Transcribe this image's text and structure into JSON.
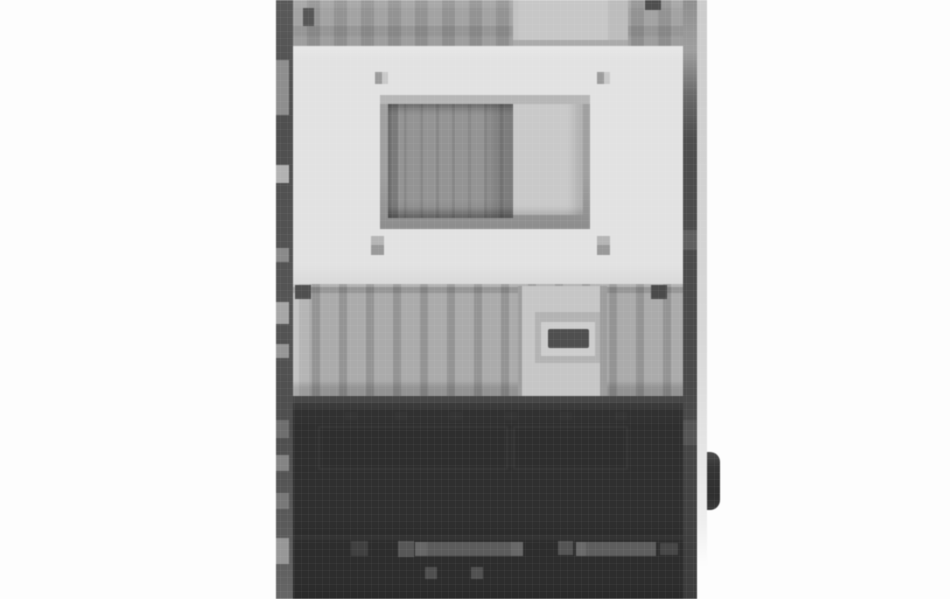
{
  "scene": {
    "type": "photograph",
    "subject": "Heavily pixelated front view of a tall gray industrial machine cabinet standing on a white background; image cropped at top and bottom",
    "background_color": "#fdfdfd"
  },
  "palette": {
    "background": "#fdfdfd",
    "frame_dark": "#4f4f4f",
    "frame_light": "#d8d8d8",
    "ribbed_light": "#a8a8a8",
    "ribbed_dark": "#939393",
    "face_panel": "#e2e2e2",
    "window_frame": "#a0a0a0",
    "window_dark_pane": "#909090",
    "window_light_pane": "#c9c9c9",
    "drawer_strip": "#c6c6c6",
    "handle_slot": "#4f4f4f",
    "lower_housing": "#2f2f2f",
    "bottom_housing": "#2d2d2d",
    "knob": "#333333"
  },
  "device": {
    "left_frame": {
      "color": "#4f4f4f",
      "patches": [
        {
          "l": 0,
          "t": 60,
          "w": 13,
          "h": 55,
          "c": "#8e8e8e",
          "name": "left-frame-highlight"
        },
        {
          "l": 0,
          "t": 165,
          "w": 13,
          "h": 18,
          "c": "#b2b2b2",
          "name": "left-frame-highlight"
        },
        {
          "l": 0,
          "t": 248,
          "w": 13,
          "h": 14,
          "c": "#8a8a8a",
          "name": "left-frame-highlight"
        },
        {
          "l": 0,
          "t": 302,
          "w": 13,
          "h": 22,
          "c": "#a6a6a6",
          "name": "left-frame-highlight"
        },
        {
          "l": 0,
          "t": 344,
          "w": 13,
          "h": 14,
          "c": "#969696",
          "name": "left-frame-highlight"
        },
        {
          "l": 0,
          "t": 420,
          "w": 13,
          "h": 18,
          "c": "#6e6e6e",
          "name": "left-frame-shadow"
        },
        {
          "l": 0,
          "t": 455,
          "w": 13,
          "h": 16,
          "c": "#848484",
          "name": "left-frame-highlight"
        },
        {
          "l": 0,
          "t": 493,
          "w": 13,
          "h": 16,
          "c": "#787878",
          "name": "left-frame-highlight"
        },
        {
          "l": 0,
          "t": 538,
          "w": 13,
          "h": 26,
          "c": "#979797",
          "name": "left-frame-highlight"
        }
      ]
    },
    "right_frame": {
      "dark_color": "#4a4a4a",
      "light_color": "#d8d8d8",
      "patches": [
        {
          "l": 0,
          "t": 230,
          "w": 14,
          "h": 20,
          "c": "#5f5f5f",
          "name": "right-frame-highlight"
        },
        {
          "l": 0,
          "t": 420,
          "w": 14,
          "h": 25,
          "c": "#555555",
          "name": "right-frame-highlight"
        }
      ]
    },
    "top_section": {
      "ribbed_light": "#a3a3a3",
      "ribbed_dark": "#939393",
      "smooth_panel_color": "#c7c7c7",
      "marks": [
        {
          "l": 10,
          "t": 8,
          "w": 11,
          "h": 18,
          "c": "#565656",
          "name": "top-left-notch"
        },
        {
          "l": 352,
          "t": 0,
          "w": 16,
          "h": 10,
          "c": "#4f4f4f",
          "name": "top-right-notch"
        }
      ]
    },
    "face_panel": {
      "color": "#e2e2e2",
      "screws": [
        {
          "l": 82,
          "t": 26,
          "w": 13,
          "h": 12,
          "c": "linear-gradient(90deg,#9b9b9b 0 7px,#c9c9c9 7px)",
          "name": "screw-top-left"
        },
        {
          "l": 304,
          "t": 26,
          "w": 13,
          "h": 12,
          "c": "linear-gradient(90deg,#9b9b9b 0 7px,#c9c9c9 7px)",
          "name": "screw-top-right"
        },
        {
          "l": 78,
          "t": 190,
          "w": 13,
          "h": 19,
          "c": "linear-gradient(180deg,#b5b5b5 0 9px,#999999 9px)",
          "name": "screw-bottom-left"
        },
        {
          "l": 304,
          "t": 190,
          "w": 13,
          "h": 19,
          "c": "linear-gradient(180deg,#b5b5b5 0 9px,#999999 9px)",
          "name": "screw-bottom-right"
        }
      ],
      "window": {
        "frame_color": "#a0a0a0",
        "dark_pane_color": "#909090",
        "light_pane_color": "#c9c9c9"
      }
    },
    "mid_section": {
      "ribbed_light": "#ababab",
      "ribbed_dark": "#949494",
      "strip_color": "#c6c6c6",
      "recess_color": "#b3b3b3",
      "slot_color": "#4f4f4f",
      "bolts": [
        {
          "l": 2,
          "t": 1,
          "w": 16,
          "h": 14,
          "c": "#4f4f4f",
          "name": "mid-bolt-left"
        },
        {
          "l": 358,
          "t": 1,
          "w": 16,
          "h": 14,
          "c": "#4a4a4a",
          "name": "mid-bolt-right"
        }
      ]
    },
    "dark_section": {
      "color": "#2f2f2f",
      "details": [
        {
          "l": 25,
          "t": 23,
          "w": 190,
          "h": 44,
          "c": "#373737",
          "name": "recessed-panel-outline"
        },
        {
          "l": 27,
          "t": 25,
          "w": 186,
          "h": 40,
          "c": "#2e2e2e",
          "name": "recessed-panel-fill"
        },
        {
          "l": 220,
          "t": 23,
          "w": 115,
          "h": 44,
          "c": "#373737",
          "name": "recessed-panel-outline"
        },
        {
          "l": 222,
          "t": 25,
          "w": 111,
          "h": 40,
          "c": "#2e2e2e",
          "name": "recessed-panel-fill"
        },
        {
          "l": 52,
          "t": 9,
          "w": 12,
          "h": 8,
          "c": "#343434",
          "name": "vent-mark"
        },
        {
          "l": 102,
          "t": 9,
          "w": 12,
          "h": 8,
          "c": "#343434",
          "name": "vent-mark"
        },
        {
          "l": 157,
          "t": 9,
          "w": 12,
          "h": 8,
          "c": "#343434",
          "name": "vent-mark"
        },
        {
          "l": 212,
          "t": 9,
          "w": 12,
          "h": 8,
          "c": "#343434",
          "name": "vent-mark"
        },
        {
          "l": 267,
          "t": 9,
          "w": 12,
          "h": 8,
          "c": "#343434",
          "name": "vent-mark"
        },
        {
          "l": 322,
          "t": 9,
          "w": 12,
          "h": 8,
          "c": "#343434",
          "name": "vent-mark"
        }
      ],
      "dots": [
        {
          "l": 75,
          "t": 78,
          "w": 14,
          "h": 14,
          "c": "#212121",
          "name": "fastener-dot"
        },
        {
          "l": 189,
          "t": 78,
          "w": 14,
          "h": 14,
          "c": "#212121",
          "name": "fastener-dot"
        },
        {
          "l": 293,
          "t": 78,
          "w": 14,
          "h": 14,
          "c": "#212121",
          "name": "fastener-dot"
        },
        {
          "l": 59,
          "t": 93,
          "w": 12,
          "h": 9,
          "c": "#292929",
          "name": "fastener-shadow"
        },
        {
          "l": 173,
          "t": 93,
          "w": 12,
          "h": 9,
          "c": "#292929",
          "name": "fastener-shadow"
        },
        {
          "l": 300,
          "t": 93,
          "w": 12,
          "h": 9,
          "c": "#292929",
          "name": "fastener-shadow"
        }
      ]
    },
    "knob": {
      "color": "#333333"
    },
    "bottom_section": {
      "color": "#2d2d2d",
      "highlights": [
        {
          "l": 58,
          "t": 6,
          "w": 17,
          "h": 15,
          "c": "#404040",
          "name": "base-highlight"
        },
        {
          "l": 105,
          "t": 6,
          "w": 16,
          "h": 16,
          "c": "#575757",
          "name": "base-highlight"
        },
        {
          "l": 122,
          "t": 7,
          "w": 108,
          "h": 14,
          "c": "linear-gradient(90deg,#676767 0 12px,#5c5c5c 12px 96px,#686868 96px)",
          "name": "base-rail"
        },
        {
          "l": 265,
          "t": 6,
          "w": 15,
          "h": 14,
          "c": "#545454",
          "name": "base-highlight"
        },
        {
          "l": 283,
          "t": 7,
          "w": 80,
          "h": 14,
          "c": "linear-gradient(90deg,#6a6a6a 0 10px,#5e5e5e 10px)",
          "name": "base-rail"
        },
        {
          "l": 367,
          "t": 8,
          "w": 18,
          "h": 12,
          "c": "#474747",
          "name": "base-highlight"
        }
      ],
      "dots": [
        {
          "l": 132,
          "t": 32,
          "w": 12,
          "h": 12,
          "c": "#4f4f4f",
          "name": "base-dot"
        },
        {
          "l": 178,
          "t": 32,
          "w": 12,
          "h": 12,
          "c": "#515151",
          "name": "base-dot"
        }
      ]
    }
  }
}
